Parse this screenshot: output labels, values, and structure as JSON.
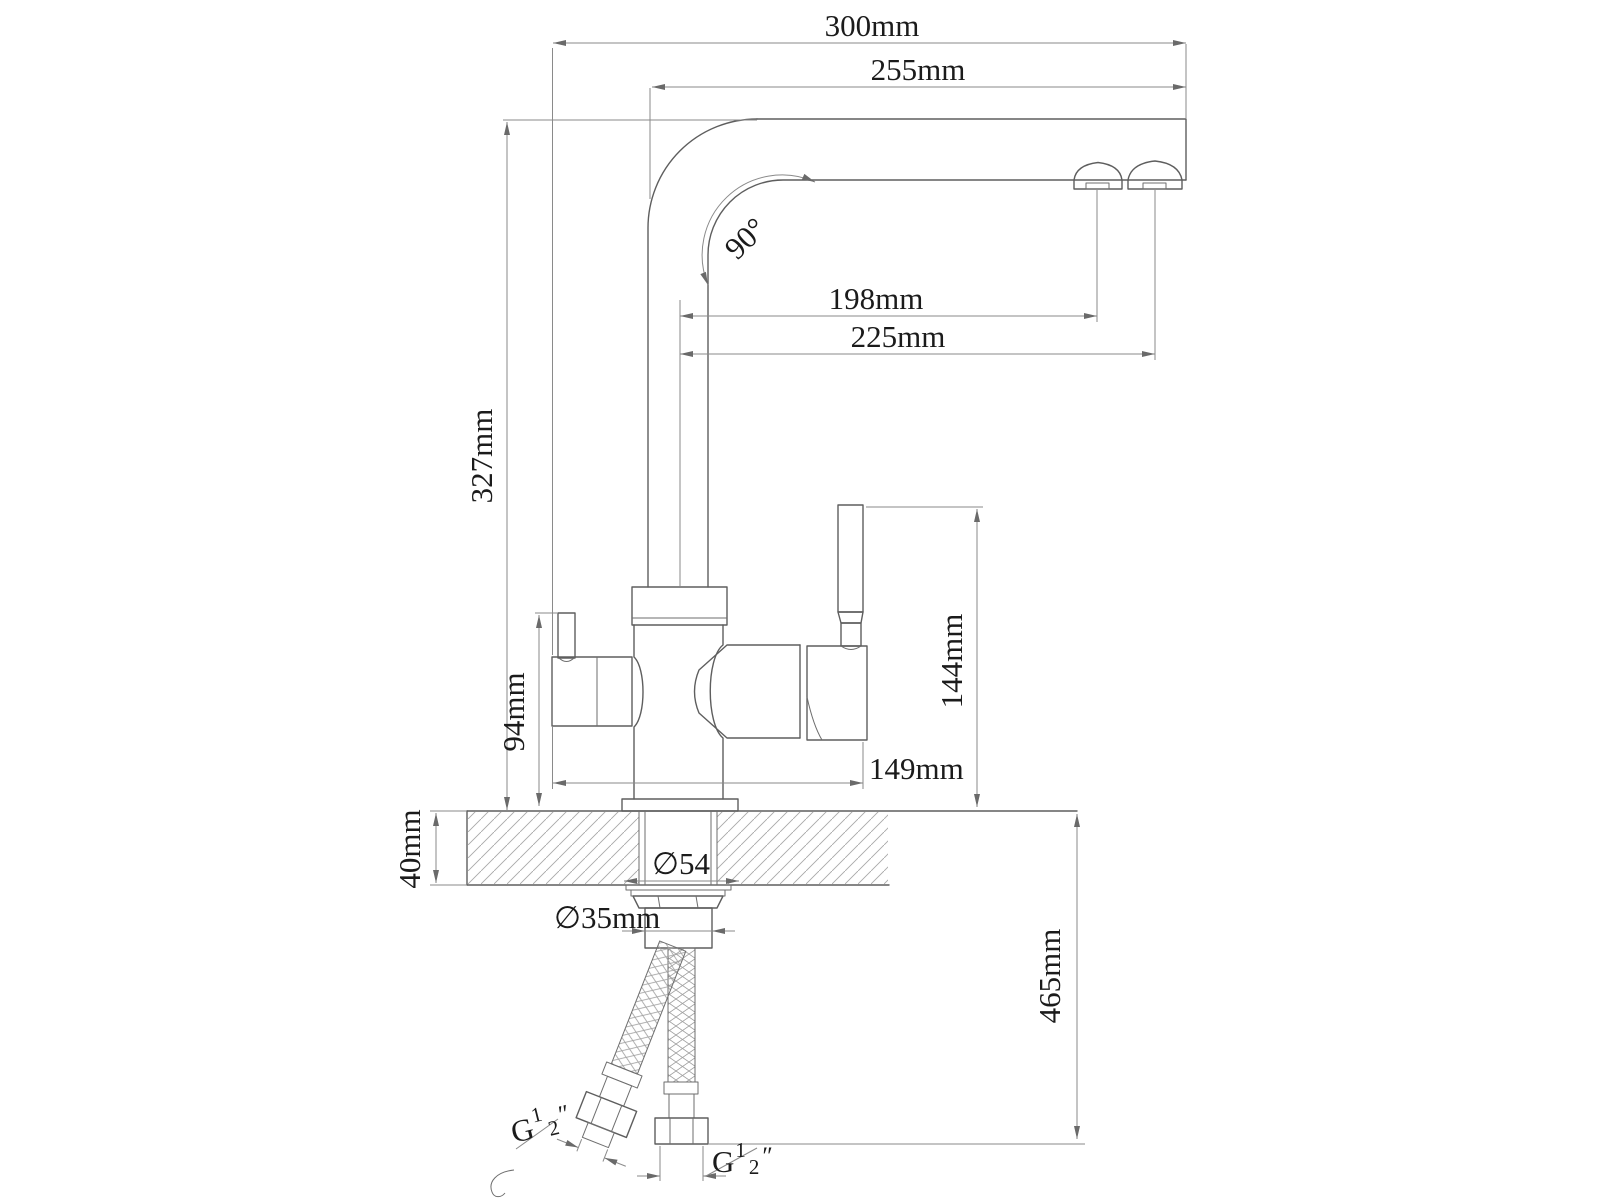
{
  "drawing": {
    "type": "technical-dimension-drawing",
    "subject": "kitchen mixer faucet with filtered-water channel, side elevation with countertop mounting and supply hoses",
    "units": "mm",
    "colors": {
      "background": "#ffffff",
      "object_line": "#5e5e5e",
      "dimension_line": "#8a8a8a",
      "hatch_line": "#a8a8a8",
      "text": "#1b1b1b"
    }
  },
  "dimensions": {
    "overall_width": "300mm",
    "spout_reach": "255mm",
    "spout_angle": "90°",
    "aerator_main_offset": "198mm",
    "aerator_tip_offset": "225mm",
    "height_countertop_to_spout_top": "327mm",
    "filter_handle_height": "94mm",
    "mixer_handle_height": "144mm",
    "body_span": "149mm",
    "countertop_thickness": "40mm",
    "escutcheon_diameter": "∅54",
    "shank_diameter": "∅35mm",
    "hose_drop_length": "465mm",
    "thread_left": {
      "prefix": "G",
      "numerator": "1",
      "denominator": "2",
      "suffix": "″"
    },
    "thread_right": {
      "prefix": "G",
      "numerator": "1",
      "denominator": "2",
      "suffix": "″"
    }
  }
}
